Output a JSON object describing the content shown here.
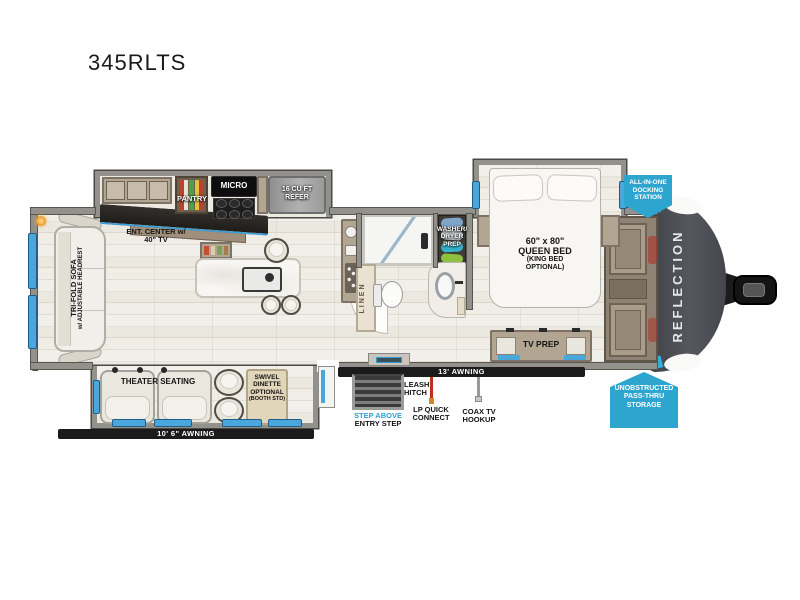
{
  "title": "345RLTS",
  "brand": "REFLECTION",
  "badges": {
    "docking": {
      "line1": "ALL-IN-ONE",
      "line2": "DOCKING",
      "line3": "STATION"
    },
    "passthru": {
      "line1": "UNOBSTRUCTED",
      "line2": "PASS-THRU",
      "line3": "STORAGE"
    }
  },
  "labels": {
    "ent_center": {
      "line1": "ENT. CENTER w/",
      "line2": "40\" TV"
    },
    "pantry": "PANTRY",
    "micro": "MICRO",
    "refer": {
      "line1": "16 CU FT",
      "line2": "REFER"
    },
    "washer": {
      "line1": "WASHER/",
      "line2": "DRYER",
      "line3": "PREP"
    },
    "linen": "LINEN",
    "bed": {
      "line1": "60\" x 80\"",
      "line2": "QUEEN BED",
      "line3": "(KING BED",
      "line4": "OPTIONAL)"
    },
    "tv_prep": "TV PREP",
    "sofa": {
      "line1": "TRI-FOLD SOFA",
      "line2": "w/ ADJUSTABLE HEADREST"
    },
    "theater": "THEATER SEATING",
    "dinette": {
      "line1": "SWIVEL",
      "line2": "DINETTE",
      "line3": "OPTIONAL",
      "line4": "(BOOTH STD)"
    },
    "awning_rear": "10' 6\" AWNING",
    "awning_main": "13' AWNING",
    "step_above": "STEP ABOVE",
    "entry_step": "ENTRY STEP",
    "leash": {
      "line1": "LEASH",
      "line2": "HITCH"
    },
    "lp": {
      "line1": "LP QUICK",
      "line2": "CONNECT"
    },
    "coax": {
      "line1": "COAX TV",
      "line2": "HOOKUP"
    }
  },
  "colors": {
    "badge_blue": "#2ea5cf",
    "window_blue": "#4aa7db",
    "step_above_blue": "#2e9fd0",
    "front_cap_gray": "#46494e",
    "lp_red": "#c03022",
    "awning_black": "#1b1b1b"
  }
}
